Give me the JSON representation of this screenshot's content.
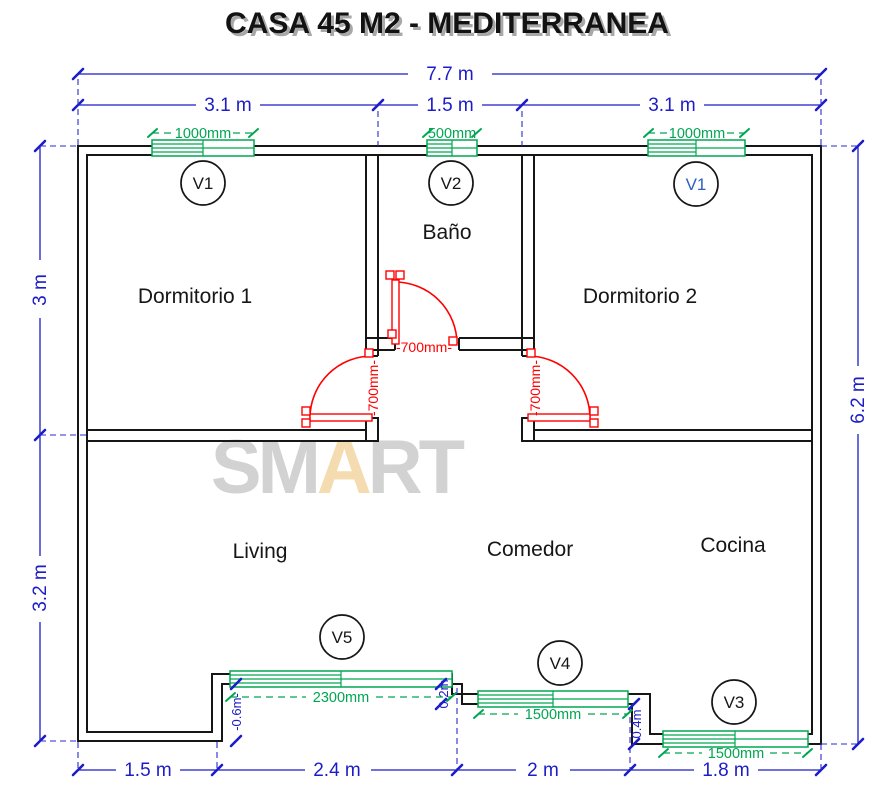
{
  "title": "CASA 45 M2 - MEDITERRANEA",
  "watermark": {
    "p1": "SM",
    "p2": "A",
    "p3": "RT",
    "gray": "#d2d2d2",
    "accent": "#f4dcb0"
  },
  "rooms": {
    "dorm1": "Dormitorio 1",
    "bath": "Baño",
    "dorm2": "Dormitorio 2",
    "living": "Living",
    "comedor": "Comedor",
    "cocina": "Cocina"
  },
  "dims": {
    "top_total": "7.7 m",
    "top_seg1": "3.1 m",
    "top_seg2": "1.5 m",
    "top_seg3": "3.1 m",
    "left1": "3 m",
    "left2": "3.2 m",
    "right1": "6.2 m",
    "bot1": "1.5 m",
    "bot2": "2.4 m",
    "bot3": "2 m",
    "bot4": "1.8 m"
  },
  "windows": [
    {
      "tag": "V1",
      "size": "1000mm",
      "tag_color": "#161616"
    },
    {
      "tag": "V2",
      "size": "500mm",
      "tag_color": "#161616"
    },
    {
      "tag": "V1",
      "size": "1000mm",
      "tag_color": "#2b5fc4"
    },
    {
      "tag": "V5",
      "size": "2300mm",
      "tag_color": "#161616"
    },
    {
      "tag": "V4",
      "size": "1500mm",
      "tag_color": "#161616"
    },
    {
      "tag": "V3",
      "size": "1500mm",
      "tag_color": "#161616"
    }
  ],
  "doors": {
    "bath": "-700mm-",
    "dorm1": "-700mm-",
    "dorm2": "-700mm-"
  },
  "steps": {
    "s1": "-0.6m-",
    "s2": "0.2m",
    "s3": "0.4m"
  },
  "colors": {
    "wall": "#161616",
    "dim_blue": "#1c1cc8",
    "window_green": "#00a651",
    "door_red": "#ff0000"
  }
}
